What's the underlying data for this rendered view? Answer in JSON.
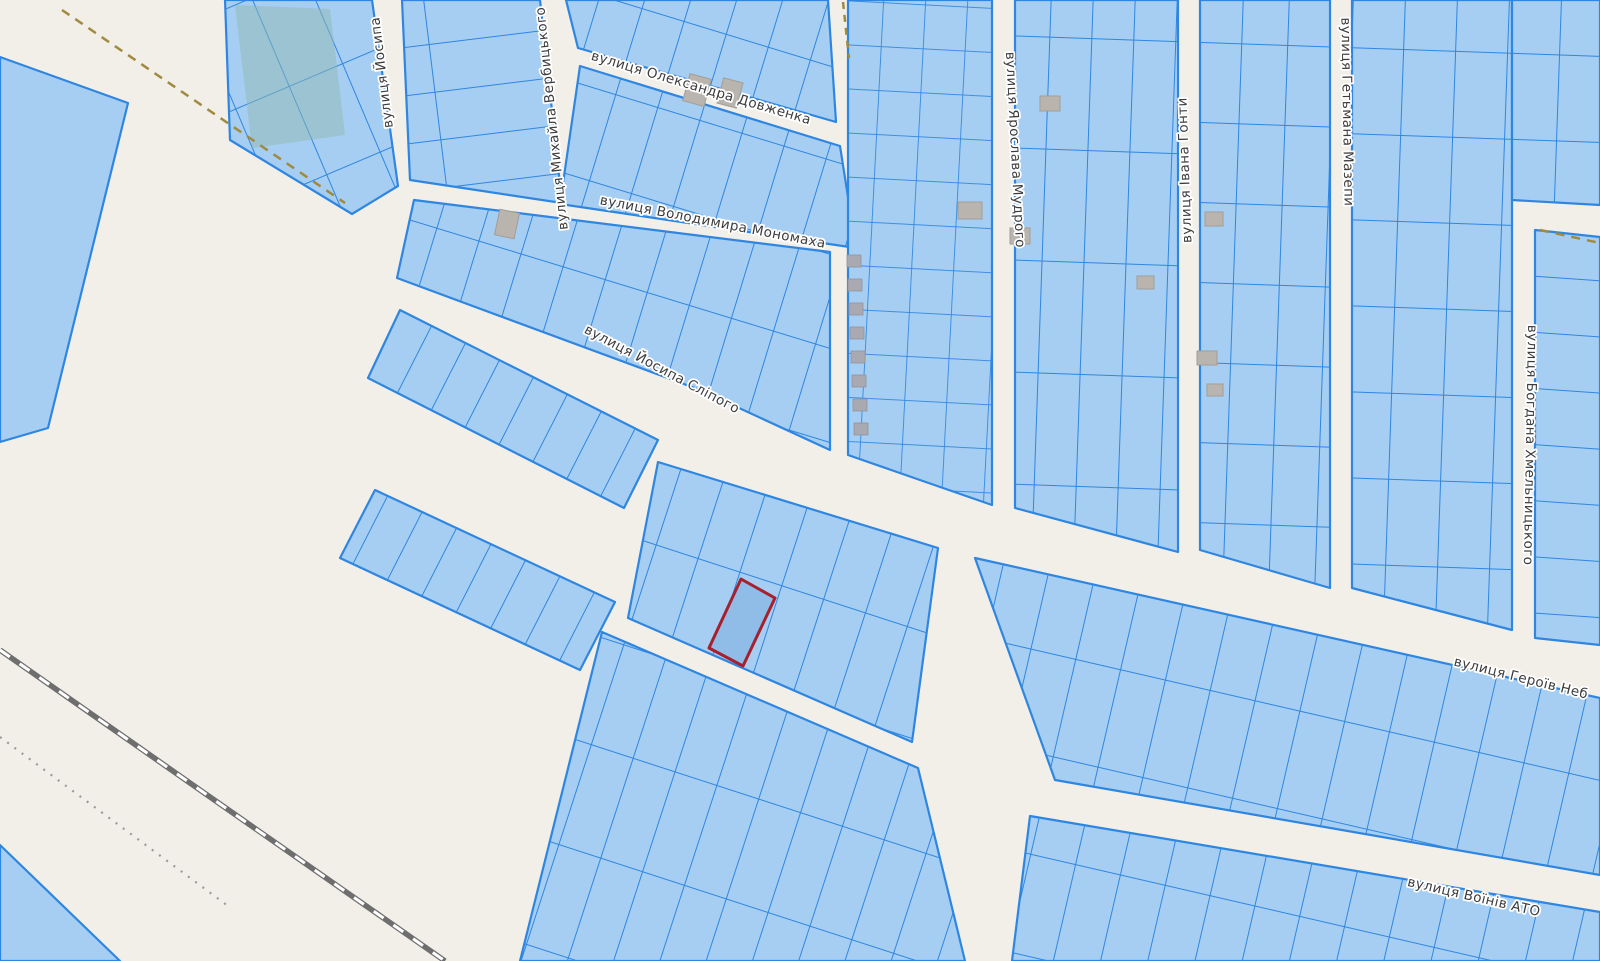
{
  "map": {
    "streets": {
      "dovzhenka": "вулиця Олександра Довженка",
      "monomakha": "вулиця Володимира Мономаха",
      "slipoho": "вулиця Йосипа Сліпого",
      "yosypa": "вулиця Йосипа",
      "verbytskoho": "вулиця Михайла Вербицького",
      "mudroho": "вулиця Ярослава Мудрого",
      "honty": "вулиця Івана Гонти",
      "mazepy": "вулиця Гетьмана Мазепи",
      "khmelnytskoho": "вулиця Богдана Хмельницького",
      "heroiv": "вулиця Героїв Неб",
      "voiniv_ato": "вулиця Воїнів АТО"
    },
    "colors": {
      "background": "#f2efe9",
      "parcel_fill": "#a6cef2",
      "parcel_border": "#2f86e0",
      "selected_parcel_fill": "#8fbde8",
      "selected_parcel_border": "#a6202e",
      "green_area": "#8fb8b2",
      "building": "#b9b5ae",
      "railway": "#6e6e6e",
      "boundary_dash": "#a08a3e",
      "label_text": "#3c3c3c"
    }
  }
}
